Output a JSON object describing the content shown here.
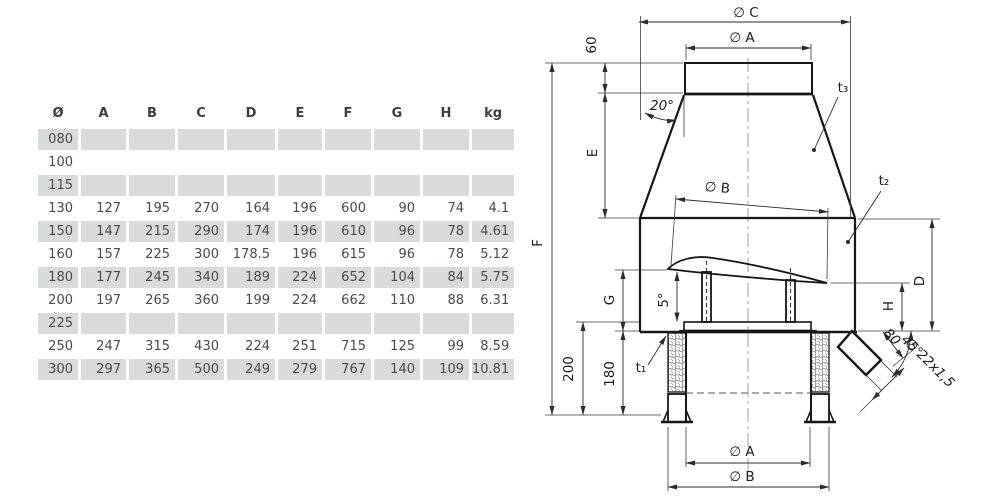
{
  "table": {
    "headers": [
      "Ø",
      "A",
      "B",
      "C",
      "D",
      "E",
      "F",
      "G",
      "H",
      "kg"
    ],
    "rows": [
      {
        "size": "080",
        "values": [
          "",
          "",
          "",
          "",
          "",
          "",
          "",
          "",
          ""
        ]
      },
      {
        "size": "100",
        "values": [
          "",
          "",
          "",
          "",
          "",
          "",
          "",
          "",
          ""
        ]
      },
      {
        "size": "115",
        "values": [
          "",
          "",
          "",
          "",
          "",
          "",
          "",
          "",
          ""
        ]
      },
      {
        "size": "130",
        "values": [
          "127",
          "195",
          "270",
          "164",
          "196",
          "600",
          "90",
          "74",
          "4.1"
        ]
      },
      {
        "size": "150",
        "values": [
          "147",
          "215",
          "290",
          "174",
          "196",
          "610",
          "96",
          "78",
          "4.61"
        ]
      },
      {
        "size": "160",
        "values": [
          "157",
          "225",
          "300",
          "178.5",
          "196",
          "615",
          "96",
          "78",
          "5.12"
        ]
      },
      {
        "size": "180",
        "values": [
          "177",
          "245",
          "340",
          "189",
          "224",
          "652",
          "104",
          "84",
          "5.75"
        ]
      },
      {
        "size": "200",
        "values": [
          "197",
          "265",
          "360",
          "199",
          "224",
          "662",
          "110",
          "88",
          "6.31"
        ]
      },
      {
        "size": "225",
        "values": [
          "",
          "",
          "",
          "",
          "",
          "",
          "",
          "",
          ""
        ]
      },
      {
        "size": "250",
        "values": [
          "247",
          "315",
          "430",
          "224",
          "251",
          "715",
          "125",
          "99",
          "8.59"
        ]
      },
      {
        "size": "300",
        "values": [
          "297",
          "365",
          "500",
          "249",
          "279",
          "767",
          "140",
          "109",
          "10.81"
        ]
      }
    ],
    "shaded_row_color": "#d9dbdb",
    "text_color": "#4a4a4a"
  },
  "drawing": {
    "labels": {
      "oc": "∅ C",
      "oa_top": "∅ A",
      "ob_mid": "∅ B",
      "oa_bottom": "∅ A",
      "ob_bottom": "∅ B",
      "dim60": "60",
      "dim20": "20°",
      "e": "E",
      "f": "F",
      "g": "G",
      "dim5": "5°",
      "dim200": "200",
      "dim180": "180",
      "d": "D",
      "h": "H",
      "dim80": "80",
      "dim45": "45°",
      "tube_spec": "∅ 22x1,5",
      "t1": "t₁",
      "t2": "t₂",
      "t3": "t₃"
    },
    "line_color": "#161616",
    "dim_color": "#2b2b2b"
  }
}
